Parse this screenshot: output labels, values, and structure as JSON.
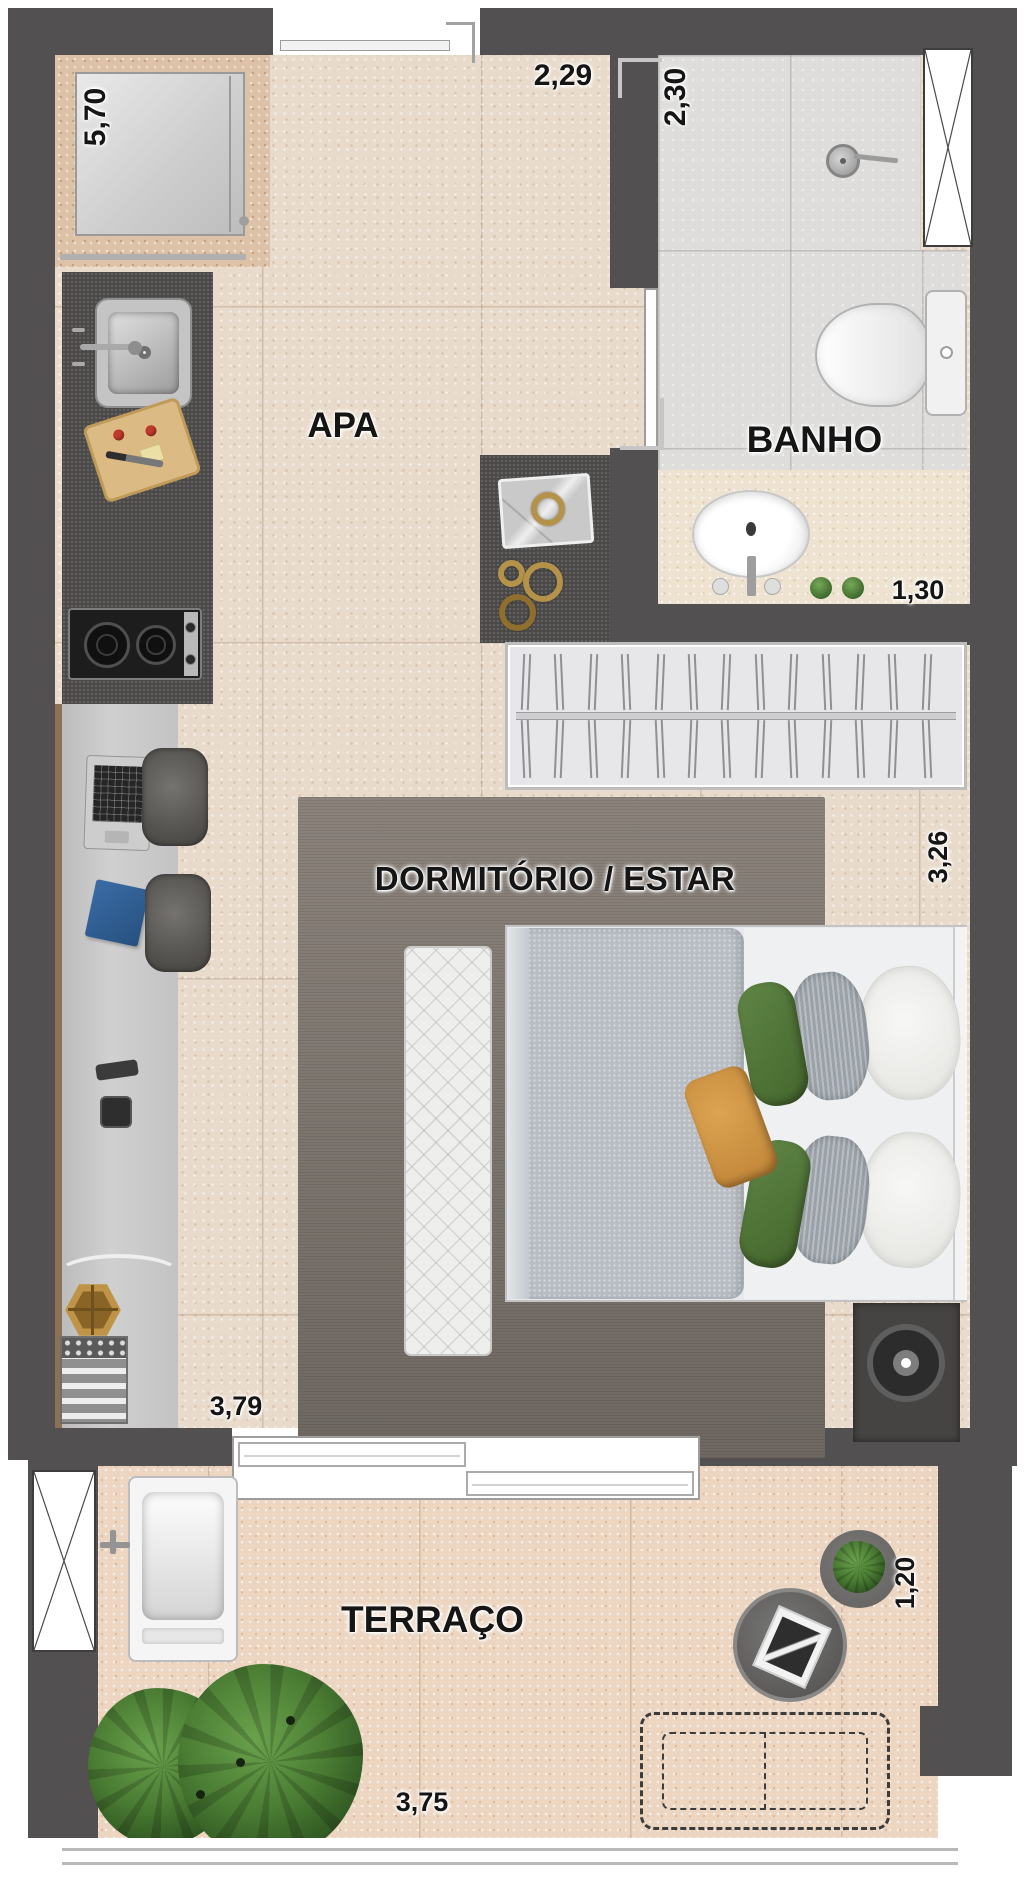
{
  "plan": {
    "rooms": {
      "apa": "APA",
      "banho": "BANHO",
      "dormitorio": "DORMITÓRIO / ESTAR",
      "terraco": "TERRAÇO"
    },
    "dims": {
      "k570": "5,70",
      "k229": "2,29",
      "k230": "2,30",
      "k130": "1,30",
      "k326": "3,26",
      "k379": "3,79",
      "k120": "1,20",
      "k375": "3,75"
    },
    "wardrobe": {
      "hangers": 13
    },
    "colors": {
      "wall": "#525050",
      "floor": "#e9dbcb",
      "terrace_floor": "#ecd6c2",
      "bath_tile": "#dedddb",
      "vanity_top": "#eee3d1",
      "rug": "#7d756d",
      "pillow_green": "#57793f",
      "pillow_orange": "#d19543",
      "gold": "#b5924a"
    }
  }
}
